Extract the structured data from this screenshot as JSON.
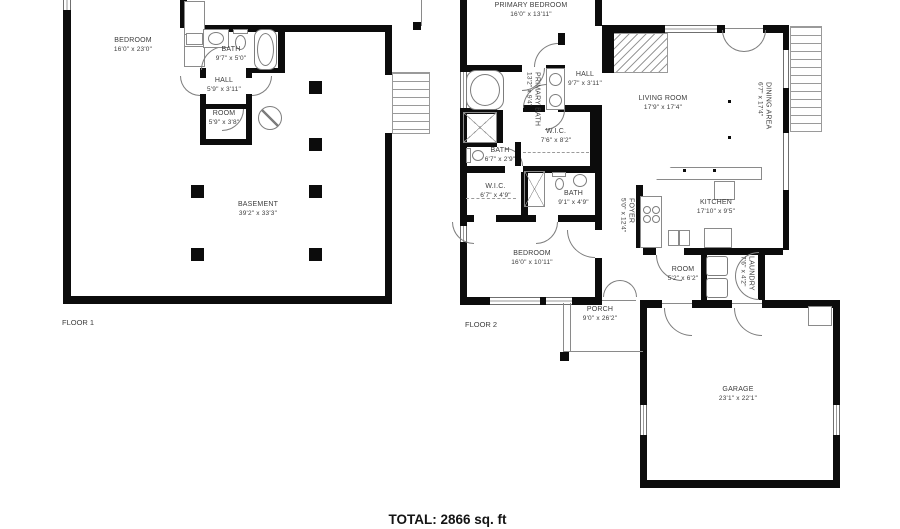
{
  "title": "Residential floor plan",
  "colors": {
    "wall": "#0c0c0c",
    "line": "#8a8a8a",
    "text": "#3c3c3c",
    "background": "#ffffff"
  },
  "icons": {
    "electrical": "circle-slash-symbol"
  },
  "floors": {
    "floor1": {
      "label": "FLOOR 1",
      "rooms": {
        "bedroom": {
          "name": "BEDROOM",
          "dims": "16'0\" x 23'0\""
        },
        "bath": {
          "name": "BATH",
          "dims": "9'7\" x 5'0\""
        },
        "hall": {
          "name": "HALL",
          "dims": "5'9\" x 3'11\""
        },
        "room": {
          "name": "ROOM",
          "dims": "5'9\" x 3'8\""
        },
        "basement": {
          "name": "BASEMENT",
          "dims": "39'2\" x 33'3\""
        }
      }
    },
    "floor2": {
      "label": "FLOOR 2",
      "rooms": {
        "primary_bedroom": {
          "name": "PRIMARY BEDROOM",
          "dims": "16'0\" x 13'11\""
        },
        "primary_bath": {
          "name": "PRIMARY BATH",
          "dims": "13'2\" x 9'4\""
        },
        "hall": {
          "name": "HALL",
          "dims": "9'7\" x 3'11\""
        },
        "wic_upper": {
          "name": "W.I.C.",
          "dims": "7'6\" x 8'2\""
        },
        "bath_small": {
          "name": "BATH",
          "dims": "6'7\" x 2'9\""
        },
        "wic_lower": {
          "name": "W.I.C.",
          "dims": "6'7\" x 4'9\""
        },
        "bath_lower": {
          "name": "BATH",
          "dims": "9'1\" x 4'9\""
        },
        "bedroom": {
          "name": "BEDROOM",
          "dims": "16'0\" x 10'11\""
        },
        "living_room": {
          "name": "LIVING ROOM",
          "dims": "17'9\" x 17'4\""
        },
        "dining_area": {
          "name": "DINING AREA",
          "dims": "6'7\" x 17'4\""
        },
        "kitchen": {
          "name": "KITCHEN",
          "dims": "17'10\" x 9'5\""
        },
        "foyer": {
          "name": "FOYER",
          "dims": "5'0\" x 12'4\""
        },
        "room": {
          "name": "ROOM",
          "dims": "5'2\" x 6'2\""
        },
        "laundry": {
          "name": "LAUNDRY",
          "dims": "7'6\" x 4'2\""
        },
        "porch": {
          "name": "PORCH",
          "dims": "9'0\" x 26'2\""
        },
        "garage": {
          "name": "GARAGE",
          "dims": "23'1\" x 22'1\""
        }
      }
    }
  },
  "total": {
    "label": "TOTAL: 2866 sq. ft"
  }
}
